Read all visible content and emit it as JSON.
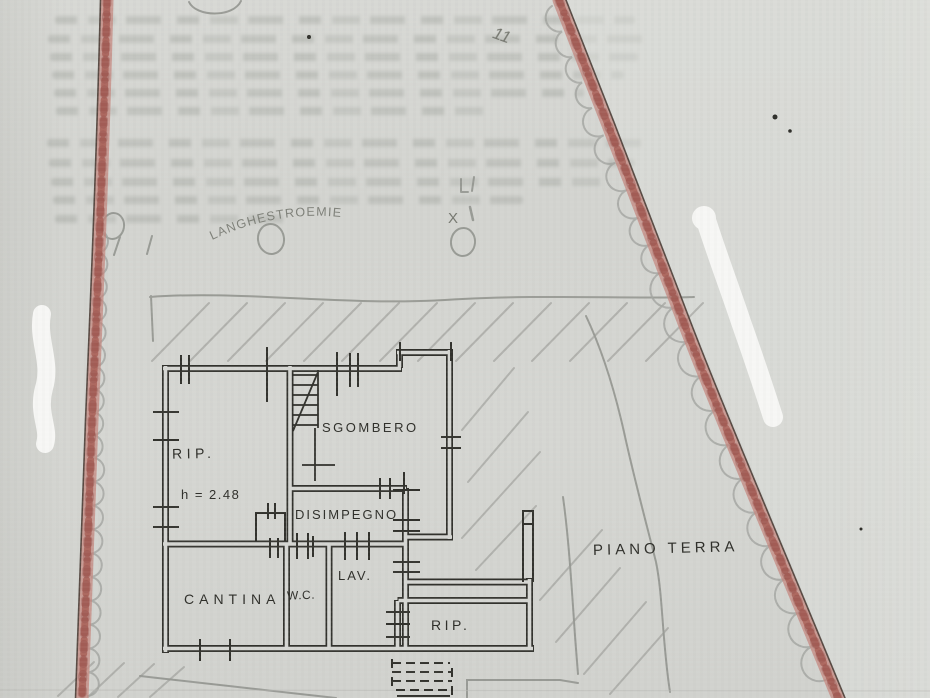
{
  "plan": {
    "floor_label": "PIANO TERRA",
    "height_annotation": "h = 2.48",
    "rooms": [
      {
        "label": "RIP."
      },
      {
        "label": "SGOMBERO"
      },
      {
        "label": "DISIMPEGNO"
      },
      {
        "label": "CANTINA"
      },
      {
        "label": "W.C."
      },
      {
        "label": "LAV."
      },
      {
        "label": "RIP."
      }
    ]
  },
  "annotations": {
    "plant_label": "LANGHESTROEMIE",
    "count_mark": "11",
    "x_mark": "X"
  },
  "colors": {
    "paper": "#d5d6d2",
    "ink": "#31312c",
    "pencil": "#8e908b",
    "boundary_red": "#b25e56",
    "whiteout": "#f8f8f6"
  }
}
